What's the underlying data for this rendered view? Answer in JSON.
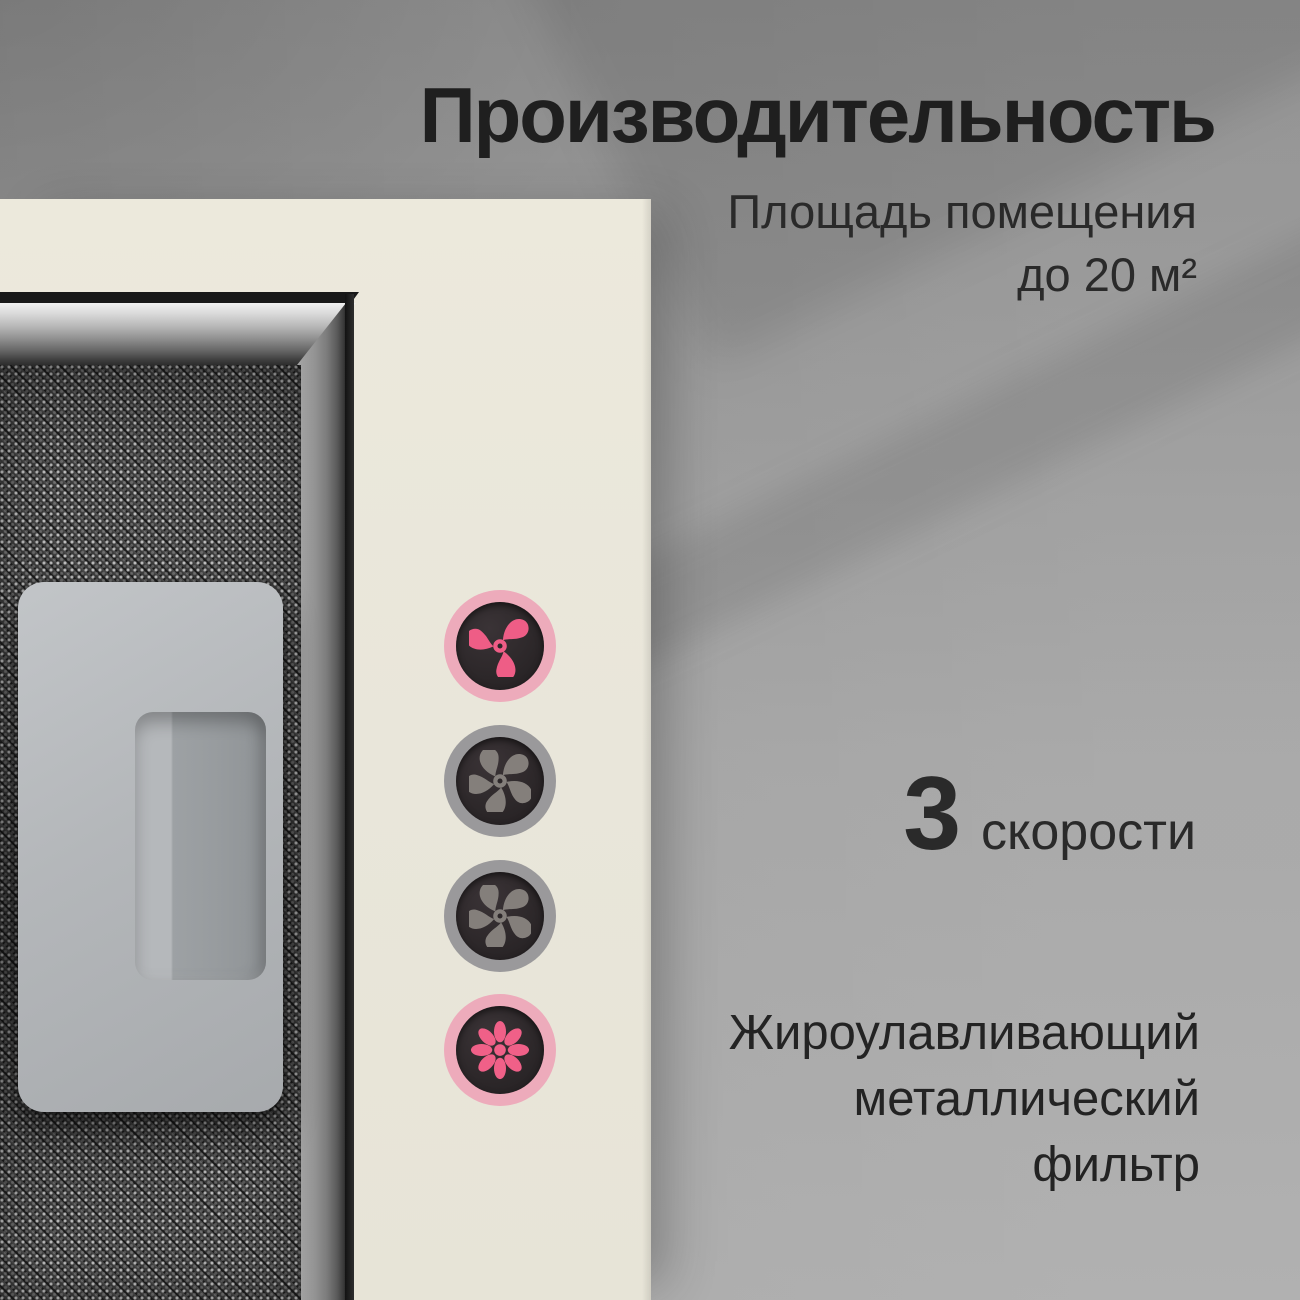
{
  "title": "Производительность",
  "specs": {
    "area": {
      "line1": "Площадь помещения",
      "line2": "до 20 м²"
    },
    "speeds": {
      "value": "3",
      "label": "скорости"
    },
    "filter": {
      "line1": "Жироулавливающий",
      "line2": "металлический",
      "line3": "фильтр"
    }
  },
  "controls": {
    "buttons": [
      {
        "name": "fan-speed-1",
        "icon": "fan-icon",
        "state": "highlighted-pink"
      },
      {
        "name": "fan-speed-2",
        "icon": "fan-icon",
        "state": "gray"
      },
      {
        "name": "fan-speed-3",
        "icon": "fan-icon",
        "state": "gray"
      },
      {
        "name": "light",
        "icon": "light-flower-icon",
        "state": "highlighted-pink"
      }
    ]
  },
  "colors": {
    "wall_gray": "#9b9b9b",
    "hood_cream": "#e9e6da",
    "accent_pink": "#ee5d86",
    "ring_pink": "#edabbb",
    "ring_gray": "#9a999b",
    "button_dark": "#2c2729",
    "blade_gray": "#847f7b",
    "text_dark": "#1f1f1f"
  }
}
